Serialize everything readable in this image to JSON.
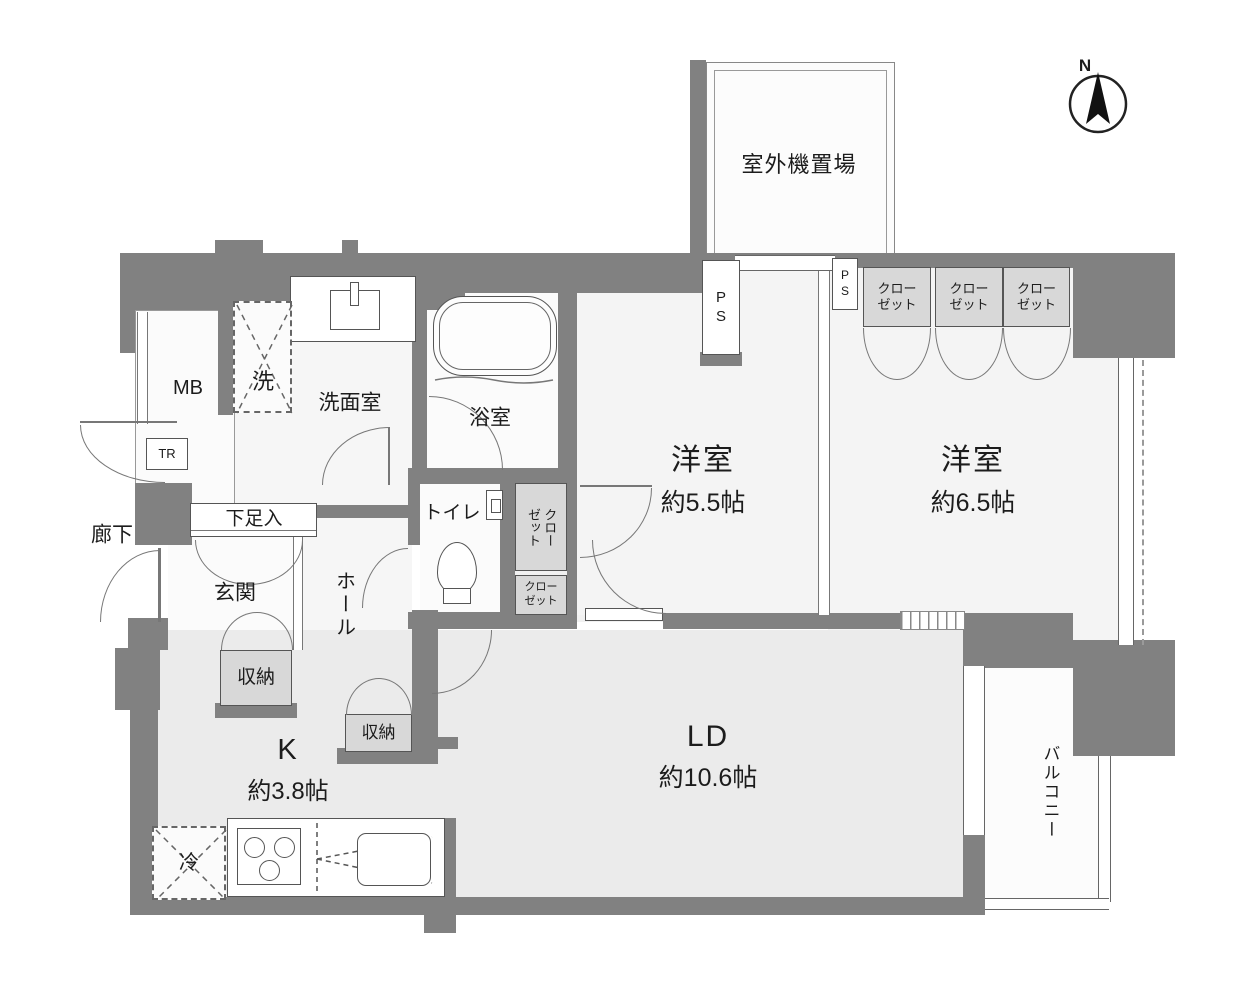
{
  "plan": {
    "compass_label": "N",
    "labels": {
      "outdoor_unit": "室外機置場",
      "corridor": "廊下",
      "mb": "MB",
      "tr": "TR",
      "washer": "洗",
      "washroom": "洗面室",
      "bathroom": "浴室",
      "toilet": "トイレ",
      "shoe_cabinet": "下足入",
      "entrance": "玄関",
      "hall": "ホール",
      "storage_entrance": "収納",
      "storage_hall": "収納",
      "closet_tall_col1": "クロー",
      "closet_tall_col2": "ゼット",
      "closet_small_line1": "クロー",
      "closet_small_line2": "ゼット",
      "ps_top": "PS",
      "ps_right": "PS",
      "fridge": "冷",
      "balcony": "バルコニー"
    },
    "rooms": {
      "bedroom_55": {
        "name": "洋室",
        "size": "約5.5帖"
      },
      "bedroom_65": {
        "name": "洋室",
        "size": "約6.5帖"
      },
      "living_dining": {
        "name": "LD",
        "size": "約10.6帖"
      },
      "kitchen": {
        "name": "K",
        "size": "約3.8帖"
      }
    },
    "closets_top": [
      {
        "line1": "クロー",
        "line2": "ゼット"
      },
      {
        "line1": "クロー",
        "line2": "ゼット"
      },
      {
        "line1": "クロー",
        "line2": "ゼット"
      }
    ],
    "colors": {
      "wall": "#818181",
      "floor": "#ededed",
      "room_light": "#fafafa",
      "closet_fill": "#d8d8d8",
      "line": "#666666"
    }
  }
}
